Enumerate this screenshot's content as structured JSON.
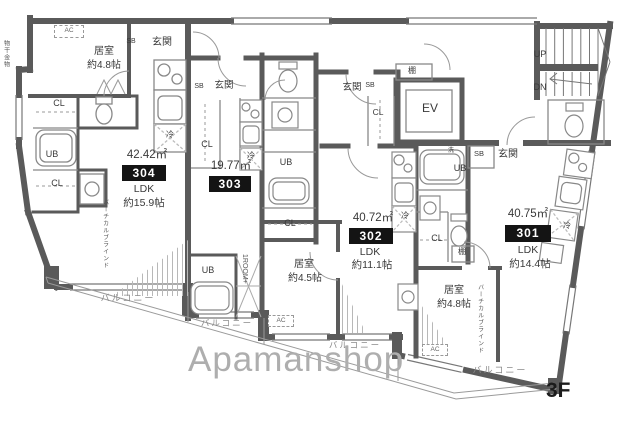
{
  "watermark": "Apamanshop",
  "floor_label": "3F",
  "common": {
    "up": "UP",
    "down": "DN",
    "elevator": "EV"
  },
  "labels": {
    "entrance": "玄関",
    "shoe_box": "SB",
    "closet": "CL",
    "unit_bath": "UB",
    "fridge": "冷",
    "ac": "AC",
    "balcony": "バルコニー",
    "vertical_blind": "バーチカルブラインド",
    "laundry_fitting": "物干金物",
    "one_room_plus": "1ROOM+",
    "shelf": "棚",
    "washer": "洗"
  },
  "units": {
    "u304": {
      "number": "304",
      "area": "42.42㎡",
      "type": "LDK",
      "size": "約15.9帖",
      "bedroom_name": "居室",
      "bedroom_size": "約4.8帖"
    },
    "u303": {
      "number": "303",
      "area": "19.77㎡"
    },
    "u302": {
      "number": "302",
      "area": "40.72㎡",
      "type": "LDK",
      "size": "約11.1帖",
      "bedroom_name": "居室",
      "bedroom_size": "約4.5帖"
    },
    "u301": {
      "number": "301",
      "area": "40.75㎡",
      "type": "LDK",
      "size": "約14.4帖",
      "bedroom_name": "居室",
      "bedroom_size": "約4.8帖"
    }
  }
}
